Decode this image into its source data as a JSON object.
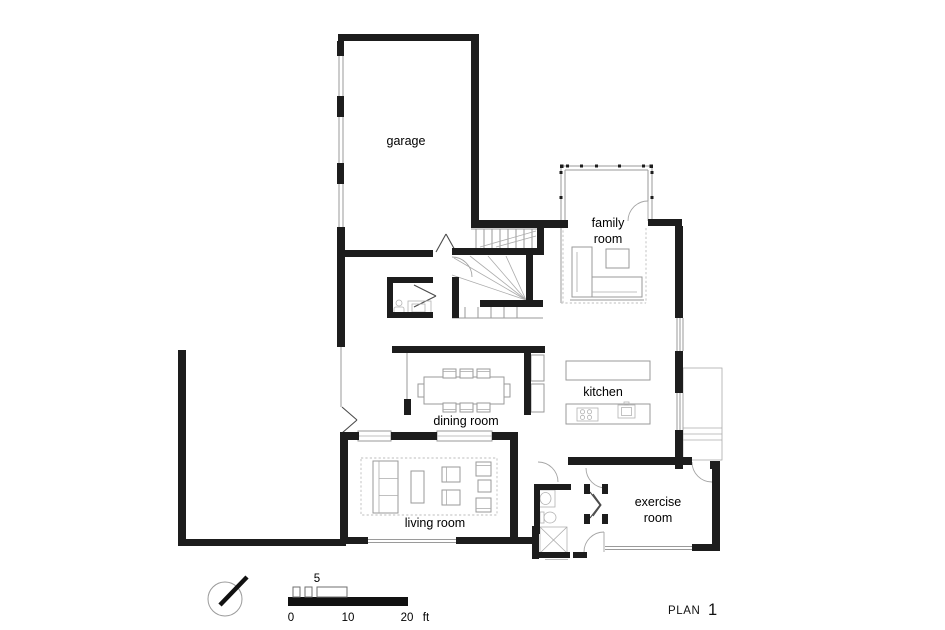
{
  "plan": {
    "colors": {
      "wall": "#1d1d1d",
      "thin_line": "#9a9a9a",
      "text": "#000000",
      "background": "#ffffff"
    },
    "rooms": {
      "garage": {
        "label": "garage"
      },
      "family": {
        "line1": "family",
        "line2": "room"
      },
      "kitchen": {
        "label": "kitchen"
      },
      "dining": {
        "label": "dining room"
      },
      "living": {
        "label": "living room"
      },
      "exercise": {
        "line1": "exercise",
        "line2": "room"
      }
    },
    "scale_bar": {
      "tick_zero": "0",
      "tick_five": "5",
      "tick_ten": "10",
      "tick_twenty": "20",
      "unit": "ft"
    },
    "title": {
      "label": "PLAN",
      "number": "1"
    }
  }
}
